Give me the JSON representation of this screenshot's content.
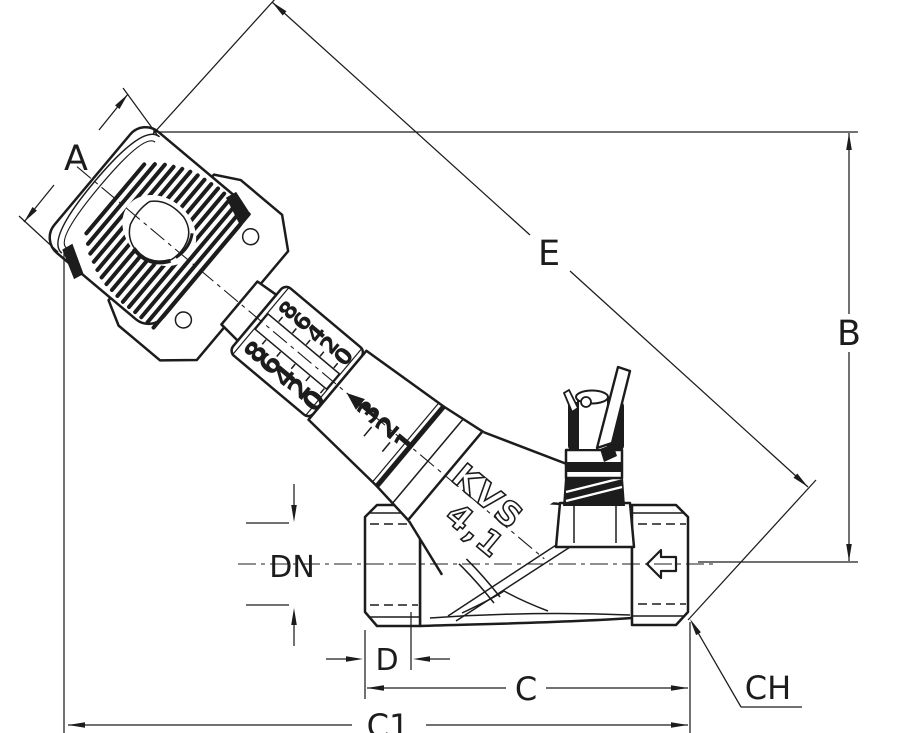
{
  "drawing": {
    "background": "#ffffff",
    "line_color": "#1c1c1c",
    "dimension_labels": {
      "a": "A",
      "b": "B",
      "c": "C",
      "c1": "C1",
      "d": "D",
      "dn": "DN",
      "e": "E",
      "ch": "CH"
    },
    "valve": {
      "kvs_label": "KVS",
      "kvs_value": "4,1",
      "memory_scale_outer_row": [
        "8",
        "6",
        "4",
        "2",
        "0"
      ],
      "memory_scale_inner_row": [
        "8",
        "6",
        "4",
        "2",
        "0"
      ],
      "turns_scale": [
        "3",
        "2",
        "1"
      ]
    }
  }
}
